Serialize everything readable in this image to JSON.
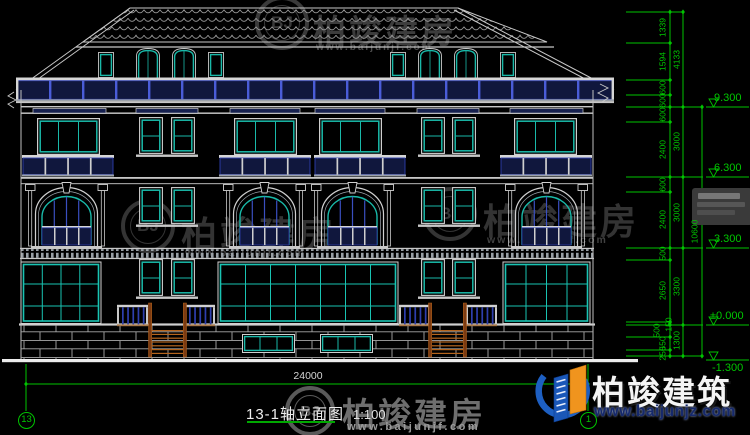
{
  "drawing": {
    "title": "13-1轴立面图",
    "scale": "1:100",
    "axis_start": "13",
    "axis_end": "1",
    "total_width_dim": "24000",
    "dim_chain_segments": [
      "1339",
      "1594",
      "600",
      "600",
      "600",
      "2400",
      "600",
      "2400",
      "500",
      "2650",
      "150",
      "500",
      "550",
      "250"
    ],
    "dim_chain_subtotals": [
      "4133",
      "3000",
      "3000",
      "3300",
      "1300"
    ],
    "dim_chain_total": "10600",
    "levels": [
      "9.300",
      "6.300",
      "3.300",
      "±0.000",
      "-1.300"
    ]
  },
  "watermark": {
    "badge": "BJ",
    "brand": "柏竣建房",
    "url": "www.baijunjf.com"
  },
  "logo": {
    "brand": "柏竣建筑",
    "url": "www.baijunjz.com"
  },
  "colors": {
    "dim_green": "#00c400",
    "line_white": "#c8c8c8",
    "window_teal": "#19b9a9",
    "railing_navy": "#10173d",
    "railing_blue": "#2e3fae",
    "stair_brown": "#b5651d",
    "logo_blue": "#1d5fc2",
    "logo_orange": "#f0941e"
  }
}
